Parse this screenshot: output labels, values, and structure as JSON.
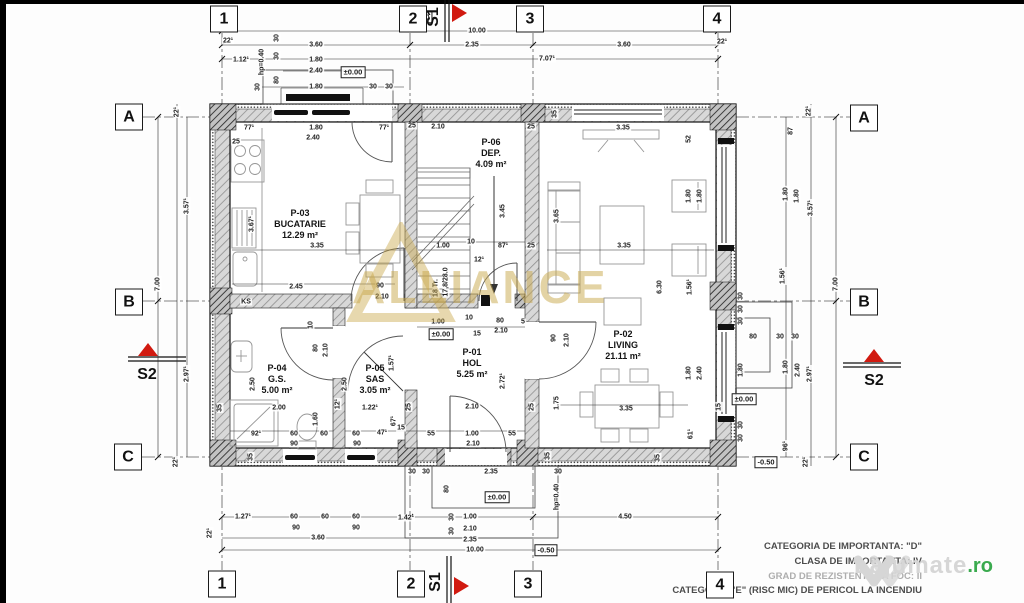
{
  "colors": {
    "section_red": "#d11a10",
    "watermark_gold": "#c9a84c",
    "lajumate_gray": "#d6d6d6",
    "lajumate_green": "#3aaa4e"
  },
  "plan": {
    "grid_cols": [
      "1",
      "2",
      "3",
      "4"
    ],
    "grid_rows": [
      "A",
      "B",
      "C"
    ],
    "sections": {
      "s1": "S1",
      "s2": "S2"
    },
    "rooms": [
      {
        "id": "P-03",
        "name": "BUCATARIE",
        "area": "12.29 m²"
      },
      {
        "id": "P-06",
        "name": "DEP.",
        "area": "4.09 m²"
      },
      {
        "id": "P-01",
        "name": "HOL",
        "area": "5.25 m²"
      },
      {
        "id": "P-05",
        "name": "SAS",
        "area": "3.05 m²"
      },
      {
        "id": "P-04",
        "name": "G.S.",
        "area": "5.00 m²"
      },
      {
        "id": "P-02",
        "name": "LIVING",
        "area": "21.11 m²"
      }
    ],
    "dimensions": [
      {
        "t": "-0.50",
        "x": 421,
        "y": 17,
        "b": 1
      },
      {
        "t": "10.00",
        "x": 477,
        "y": 31
      },
      {
        "t": "22¹",
        "x": 228,
        "y": 41
      },
      {
        "t": "3.60",
        "x": 316,
        "y": 45
      },
      {
        "t": "2.35",
        "x": 472,
        "y": 45
      },
      {
        "t": "3.60",
        "x": 624,
        "y": 45
      },
      {
        "t": "22¹",
        "x": 722,
        "y": 42
      },
      {
        "t": "1.12¹",
        "x": 241,
        "y": 60
      },
      {
        "t": "1.80",
        "x": 316,
        "y": 60
      },
      {
        "t": "7.07¹",
        "x": 547,
        "y": 59
      },
      {
        "t": "2.40",
        "x": 316,
        "y": 71
      },
      {
        "t": "±0.00",
        "x": 353,
        "y": 72,
        "b": 1
      },
      {
        "t": "1.80",
        "x": 316,
        "y": 87
      },
      {
        "t": "30",
        "x": 373,
        "y": 87
      },
      {
        "t": "30",
        "x": 389,
        "y": 87
      },
      {
        "t": "hp=0.40",
        "x": 262,
        "y": 62,
        "r": 1
      },
      {
        "t": "30",
        "x": 277,
        "y": 38,
        "r": 1
      },
      {
        "t": "30",
        "x": 277,
        "y": 56,
        "r": 1
      },
      {
        "t": "80",
        "x": 277,
        "y": 80,
        "r": 1
      },
      {
        "t": "30",
        "x": 258,
        "y": 87,
        "r": 1
      },
      {
        "t": "77¹",
        "x": 249,
        "y": 128
      },
      {
        "t": "1.80",
        "x": 316,
        "y": 128
      },
      {
        "t": "77¹",
        "x": 384,
        "y": 128
      },
      {
        "t": "2.40",
        "x": 313,
        "y": 138
      },
      {
        "t": "25",
        "x": 236,
        "y": 142
      },
      {
        "t": "25",
        "x": 412,
        "y": 126
      },
      {
        "t": "2.10",
        "x": 438,
        "y": 127
      },
      {
        "t": "25",
        "x": 531,
        "y": 127
      },
      {
        "t": "35",
        "x": 555,
        "y": 114,
        "r": 1
      },
      {
        "t": "3.35",
        "x": 623,
        "y": 128
      },
      {
        "t": "52",
        "x": 689,
        "y": 139,
        "r": 1
      },
      {
        "t": "22¹",
        "x": 177,
        "y": 112,
        "r": 1
      },
      {
        "t": "3.57¹",
        "x": 187,
        "y": 206,
        "r": 1
      },
      {
        "t": "7.00",
        "x": 158,
        "y": 284,
        "r": 1
      },
      {
        "t": "2.97¹",
        "x": 187,
        "y": 374,
        "r": 1
      },
      {
        "t": "22¹",
        "x": 176,
        "y": 462,
        "r": 1
      },
      {
        "t": "22¹",
        "x": 809,
        "y": 111,
        "r": 1
      },
      {
        "t": "87",
        "x": 791,
        "y": 131,
        "r": 1
      },
      {
        "t": "1.80",
        "x": 786,
        "y": 194,
        "r": 1
      },
      {
        "t": "1.80",
        "x": 797,
        "y": 196,
        "r": 1
      },
      {
        "t": "3.57¹",
        "x": 811,
        "y": 208,
        "r": 1
      },
      {
        "t": "1.56¹",
        "x": 783,
        "y": 276,
        "r": 1
      },
      {
        "t": "7.00",
        "x": 836,
        "y": 284,
        "r": 1
      },
      {
        "t": "30",
        "x": 741,
        "y": 296,
        "r": 1
      },
      {
        "t": "30",
        "x": 741,
        "y": 309,
        "r": 1
      },
      {
        "t": "30",
        "x": 741,
        "y": 321,
        "r": 1
      },
      {
        "t": "80",
        "x": 753,
        "y": 337
      },
      {
        "t": "30",
        "x": 780,
        "y": 337
      },
      {
        "t": "30",
        "x": 795,
        "y": 337
      },
      {
        "t": "1.80",
        "x": 741,
        "y": 370,
        "r": 1
      },
      {
        "t": "1.80",
        "x": 786,
        "y": 367,
        "r": 1
      },
      {
        "t": "2.40",
        "x": 798,
        "y": 370,
        "r": 1
      },
      {
        "t": "2.97¹",
        "x": 810,
        "y": 374,
        "r": 1
      },
      {
        "t": "±0.00",
        "x": 744,
        "y": 399,
        "b": 1
      },
      {
        "t": "30",
        "x": 741,
        "y": 425,
        "r": 1
      },
      {
        "t": "30",
        "x": 741,
        "y": 438,
        "r": 1
      },
      {
        "t": "96¹",
        "x": 786,
        "y": 446,
        "r": 1
      },
      {
        "t": "-0.50",
        "x": 766,
        "y": 462,
        "b": 1
      },
      {
        "t": "22¹",
        "x": 806,
        "y": 462,
        "r": 1
      },
      {
        "t": "3.35",
        "x": 317,
        "y": 246
      },
      {
        "t": "3.67¹",
        "x": 252,
        "y": 224,
        "r": 1
      },
      {
        "t": "2.45",
        "x": 296,
        "y": 287
      },
      {
        "t": "90",
        "x": 380,
        "y": 286
      },
      {
        "t": "2.10",
        "x": 382,
        "y": 297
      },
      {
        "t": "KS",
        "x": 246,
        "y": 302
      },
      {
        "t": "3.45",
        "x": 503,
        "y": 211,
        "r": 1
      },
      {
        "t": "3.65",
        "x": 557,
        "y": 216,
        "r": 1
      },
      {
        "t": "1.00",
        "x": 443,
        "y": 246
      },
      {
        "t": "10",
        "x": 471,
        "y": 242
      },
      {
        "t": "87¹",
        "x": 503,
        "y": 246
      },
      {
        "t": "25",
        "x": 531,
        "y": 246
      },
      {
        "t": "12¹",
        "x": 479,
        "y": 260
      },
      {
        "t": "18 Tr.",
        "x": 436,
        "y": 288,
        "r": 1
      },
      {
        "t": "17,8/28.0",
        "x": 446,
        "y": 282,
        "r": 1
      },
      {
        "t": "1.80",
        "x": 689,
        "y": 196,
        "r": 1
      },
      {
        "t": "1.80",
        "x": 700,
        "y": 196,
        "r": 1
      },
      {
        "t": "3.35",
        "x": 624,
        "y": 246
      },
      {
        "t": "6.30",
        "x": 660,
        "y": 287,
        "r": 1
      },
      {
        "t": "1.56¹",
        "x": 690,
        "y": 287,
        "r": 1
      },
      {
        "t": "90",
        "x": 554,
        "y": 338,
        "r": 1
      },
      {
        "t": "2.10",
        "x": 567,
        "y": 340,
        "r": 1
      },
      {
        "t": "1.80",
        "x": 689,
        "y": 373,
        "r": 1
      },
      {
        "t": "2.40",
        "x": 700,
        "y": 373,
        "r": 1
      },
      {
        "t": "3.35",
        "x": 626,
        "y": 409
      },
      {
        "t": "61¹",
        "x": 691,
        "y": 434,
        "r": 1
      },
      {
        "t": "15",
        "x": 719,
        "y": 407,
        "r": 1
      },
      {
        "t": "35",
        "x": 658,
        "y": 458,
        "r": 1
      },
      {
        "t": "1.00",
        "x": 438,
        "y": 322
      },
      {
        "t": "10",
        "x": 469,
        "y": 318
      },
      {
        "t": "80",
        "x": 500,
        "y": 321
      },
      {
        "t": "±0.00",
        "x": 441,
        "y": 334,
        "b": 1
      },
      {
        "t": "15",
        "x": 477,
        "y": 334
      },
      {
        "t": "2.10",
        "x": 501,
        "y": 331
      },
      {
        "t": "5",
        "x": 523,
        "y": 322
      },
      {
        "t": "1.57¹",
        "x": 392,
        "y": 363,
        "r": 1
      },
      {
        "t": "2.72¹",
        "x": 503,
        "y": 381,
        "r": 1
      },
      {
        "t": "2.50",
        "x": 345,
        "y": 384,
        "r": 1
      },
      {
        "t": "12¹",
        "x": 338,
        "y": 404,
        "r": 1
      },
      {
        "t": "1.22¹",
        "x": 370,
        "y": 408
      },
      {
        "t": "25",
        "x": 409,
        "y": 407,
        "r": 1
      },
      {
        "t": "2.10",
        "x": 472,
        "y": 407
      },
      {
        "t": "25",
        "x": 532,
        "y": 407,
        "r": 1
      },
      {
        "t": "1.75",
        "x": 557,
        "y": 403,
        "r": 1
      },
      {
        "t": "67¹",
        "x": 394,
        "y": 421,
        "r": 1
      },
      {
        "t": "60",
        "x": 356,
        "y": 434
      },
      {
        "t": "47¹",
        "x": 382,
        "y": 433
      },
      {
        "t": "15",
        "x": 401,
        "y": 428
      },
      {
        "t": "55",
        "x": 431,
        "y": 434
      },
      {
        "t": "1.00",
        "x": 472,
        "y": 434
      },
      {
        "t": "55",
        "x": 512,
        "y": 434
      },
      {
        "t": "90",
        "x": 357,
        "y": 444
      },
      {
        "t": "2.10",
        "x": 473,
        "y": 444
      },
      {
        "t": "2.50",
        "x": 253,
        "y": 384,
        "r": 1
      },
      {
        "t": "2.00",
        "x": 279,
        "y": 408
      },
      {
        "t": "92¹",
        "x": 256,
        "y": 434
      },
      {
        "t": "60",
        "x": 294,
        "y": 434
      },
      {
        "t": "90",
        "x": 294,
        "y": 444
      },
      {
        "t": "60",
        "x": 324,
        "y": 434
      },
      {
        "t": "1.60",
        "x": 316,
        "y": 419,
        "r": 1
      },
      {
        "t": "80",
        "x": 316,
        "y": 348,
        "r": 1
      },
      {
        "t": "2.10",
        "x": 326,
        "y": 350,
        "r": 1
      },
      {
        "t": "10",
        "x": 311,
        "y": 325,
        "r": 1
      },
      {
        "t": "35",
        "x": 220,
        "y": 408,
        "r": 1
      },
      {
        "t": "35",
        "x": 251,
        "y": 457,
        "r": 1
      },
      {
        "t": "30",
        "x": 412,
        "y": 472
      },
      {
        "t": "30",
        "x": 426,
        "y": 472
      },
      {
        "t": "2.35",
        "x": 491,
        "y": 472
      },
      {
        "t": "30",
        "x": 558,
        "y": 472
      },
      {
        "t": "35",
        "x": 548,
        "y": 456,
        "r": 1
      },
      {
        "t": "80",
        "x": 447,
        "y": 489,
        "r": 1
      },
      {
        "t": "±0.00",
        "x": 497,
        "y": 497,
        "b": 1
      },
      {
        "t": "hp=0.40",
        "x": 557,
        "y": 497,
        "r": 1
      },
      {
        "t": "1.27¹",
        "x": 243,
        "y": 517
      },
      {
        "t": "60",
        "x": 294,
        "y": 517
      },
      {
        "t": "60",
        "x": 325,
        "y": 517
      },
      {
        "t": "60",
        "x": 356,
        "y": 517
      },
      {
        "t": "90",
        "x": 296,
        "y": 528
      },
      {
        "t": "90",
        "x": 356,
        "y": 528
      },
      {
        "t": "1.42¹",
        "x": 406,
        "y": 518
      },
      {
        "t": "30",
        "x": 452,
        "y": 517,
        "r": 1
      },
      {
        "t": "30",
        "x": 452,
        "y": 531,
        "r": 1
      },
      {
        "t": "1.00",
        "x": 470,
        "y": 517
      },
      {
        "t": "2.10",
        "x": 470,
        "y": 529
      },
      {
        "t": "4.50",
        "x": 625,
        "y": 517
      },
      {
        "t": "3.60",
        "x": 318,
        "y": 538
      },
      {
        "t": "2.35",
        "x": 470,
        "y": 540
      },
      {
        "t": "10.00",
        "x": 475,
        "y": 550
      },
      {
        "t": "-0.50",
        "x": 546,
        "y": 550,
        "b": 1
      },
      {
        "t": "22¹",
        "x": 210,
        "y": 533,
        "r": 1
      }
    ]
  },
  "notes": [
    "CATEGORIA DE IMPORTANTA: \"D\"",
    "CLASA DE IMPORTANTA: IV",
    "GRAD DE REZISTENTA LA FOC: II",
    "CATEGORIA \"E\" (RISC MIC) DE PERICOL LA INCENDIU"
  ],
  "watermarks": {
    "center": "ALLIANCE",
    "corner_name": "Lajumate",
    "corner_tld": ".ro"
  }
}
